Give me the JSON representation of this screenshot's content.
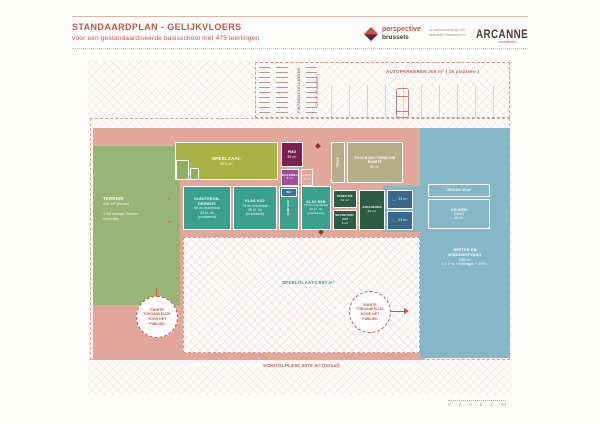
{
  "header": {
    "title": "STANDAARDPLAN - GELIJKVLOERS",
    "subtitle": "voor een gestandaardiseerde basisschool met 475 leerlingen"
  },
  "brand": {
    "perspective_top": "perspective",
    "perspective_bottom": "brussels",
    "collab_line1": "in samenwerking met",
    "collab_line2": "Mathilde Fabauma en",
    "arcanne": "ARCANNE",
    "arcanne_sub": "architecten"
  },
  "parking": {
    "bikes_line1": "FIETSENSTALLINGEN",
    "bikes_line2": "121 m² (88 plaatsen)",
    "cars_label": "AUTOPARKEREN 300 m² ( 15 plaatsen )"
  },
  "rooms": {
    "terrein": {
      "name": "TERREIN",
      "area": "465 m² (totaal)",
      "note1": "+ 54 nieuwe bomen",
      "note2": "voorzien"
    },
    "speelzaal": {
      "name": "SPEELZAAL",
      "area": "223 m²"
    },
    "pmd": {
      "name": "PMD",
      "area": "35 m²"
    },
    "keukenbar": {
      "name": "KEUKENBAR",
      "area": "8 m²"
    },
    "lift": {
      "name": "LIFT",
      "area": "6 m²"
    },
    "trap": {
      "name": "TRAP"
    },
    "psycho": {
      "line1": "PSYCHOMOTORISCHE",
      "line2": "RUIMTE",
      "area": "60 m²"
    },
    "kleuter": {
      "name1": "KLEUTERON-",
      "name2": "DERWIJS",
      "max": "66 m² maximaal",
      "cap": "23 kl. lln",
      "note": "(voorbeeld)"
    },
    "klas_ko2": {
      "name": "KLAS KO2",
      "max": "79 m² maximaal",
      "cap": "26 kl. lln",
      "note": "(voorbeeld)"
    },
    "wc": {
      "name": "WC"
    },
    "sanitair": {
      "name": "SANITAIR"
    },
    "klas_m1b": {
      "name": "KLAS M1B",
      "max": "79 m² maximaal",
      "cap": "26 kl. lln",
      "note": "(voorbeeld)"
    },
    "directie": {
      "name": "DIRECTIE",
      "area": "12 m²"
    },
    "secretariaat": {
      "name1": "SECRETARI-",
      "name2": "AAT",
      "area": "8 m²"
    },
    "archieven": {
      "name": "ARCHIEVEN",
      "area": "40 m²"
    },
    "berging_a": {
      "area": "23 m²"
    },
    "berging_b": {
      "area": "23 m²"
    },
    "opslag": {
      "name": "OPSLAG 12 m²"
    },
    "keuken": {
      "name": "KEUKEN",
      "sub": "(klein)",
      "area": "30 m²"
    },
    "refter": {
      "line1": "REFTER EN",
      "line2": "KINDEROPVANG",
      "line3": "630 m²",
      "line4": "( 1.2 m² / leerlingen + 30% )"
    },
    "speelplaats": {
      "label": "SPEELPLAATS 850 m²"
    }
  },
  "site": {
    "total_label": "SCHOOLPLEIN  3375 m² (totaal)",
    "public_circle": [
      "RUIMTE",
      "TOEGANKELIJK",
      "VOOR HET",
      "PUBLIEK"
    ],
    "dim_label": "10"
  },
  "scale": {
    "ticks": [
      "0",
      "2",
      "4",
      "6",
      "8",
      "10"
    ]
  },
  "colors": {
    "accent": "#c4564a",
    "building_pink": "#e2a69b",
    "terrain_green": "#97b575",
    "hall_olive": "#a9b244",
    "class_teal": "#3aa18d",
    "admin_green": "#2d5c46",
    "storage_blue": "#39688c",
    "refter_blue": "#85b7c6",
    "magenta": "#7b2150",
    "purple": "#9c4f94",
    "tan": "#b5ad85"
  }
}
